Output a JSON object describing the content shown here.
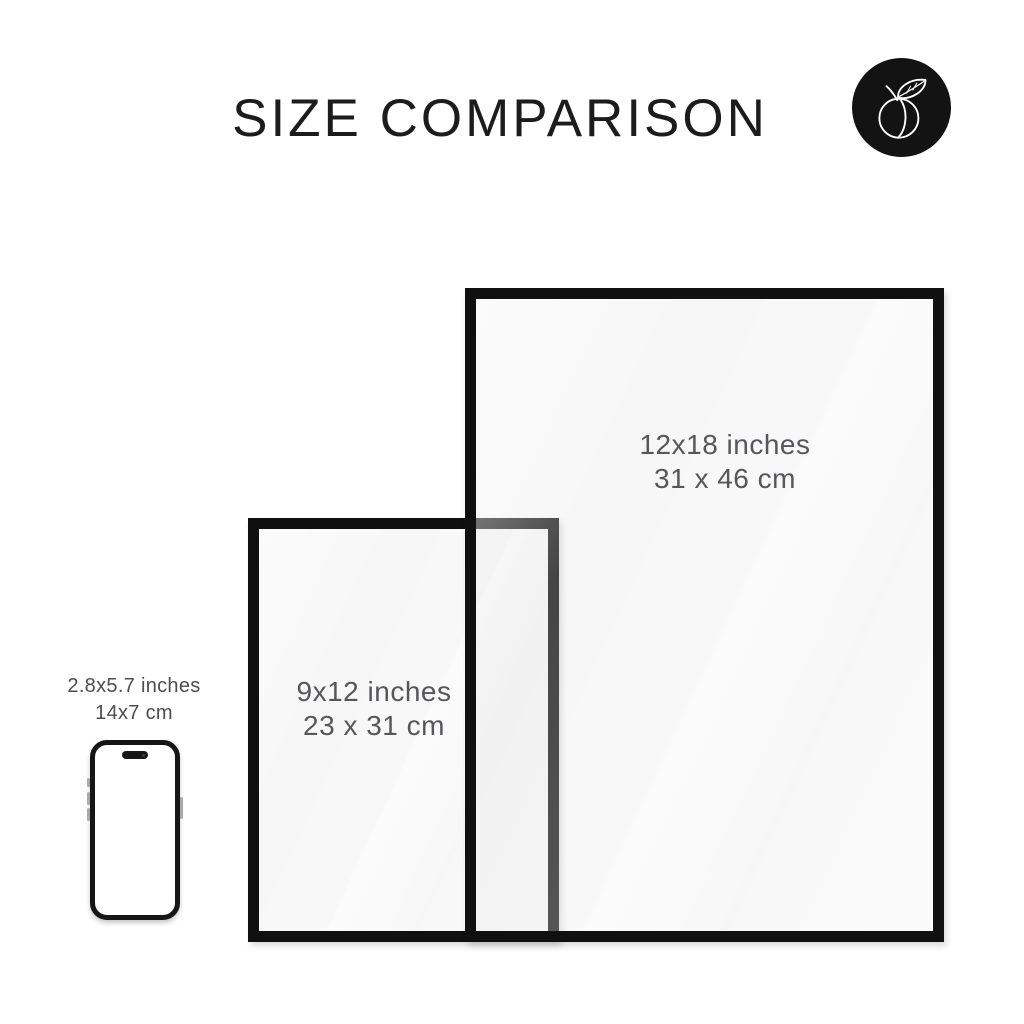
{
  "header": {
    "title": "SIZE COMPARISON"
  },
  "logo": {
    "icon": "peach-icon",
    "bg_color": "#131313",
    "stroke_color": "#ffffff"
  },
  "frames": [
    {
      "name": "frame-12x18",
      "inches": "12x18 inches",
      "cm": "31 x 46 cm"
    },
    {
      "name": "frame-9x12",
      "inches": "9x12 inches",
      "cm": "23 x 31 cm"
    }
  ],
  "phone": {
    "name": "smartphone",
    "inches": "2.8x5.7 inches",
    "cm": "14x7 cm"
  },
  "colors": {
    "background": "#ffffff",
    "title_text": "#1c1c1c",
    "frame_border": "#101010",
    "frame_label_text": "#57575a",
    "phone_label_text": "#4e4e4e",
    "badge_background": "#131313"
  }
}
